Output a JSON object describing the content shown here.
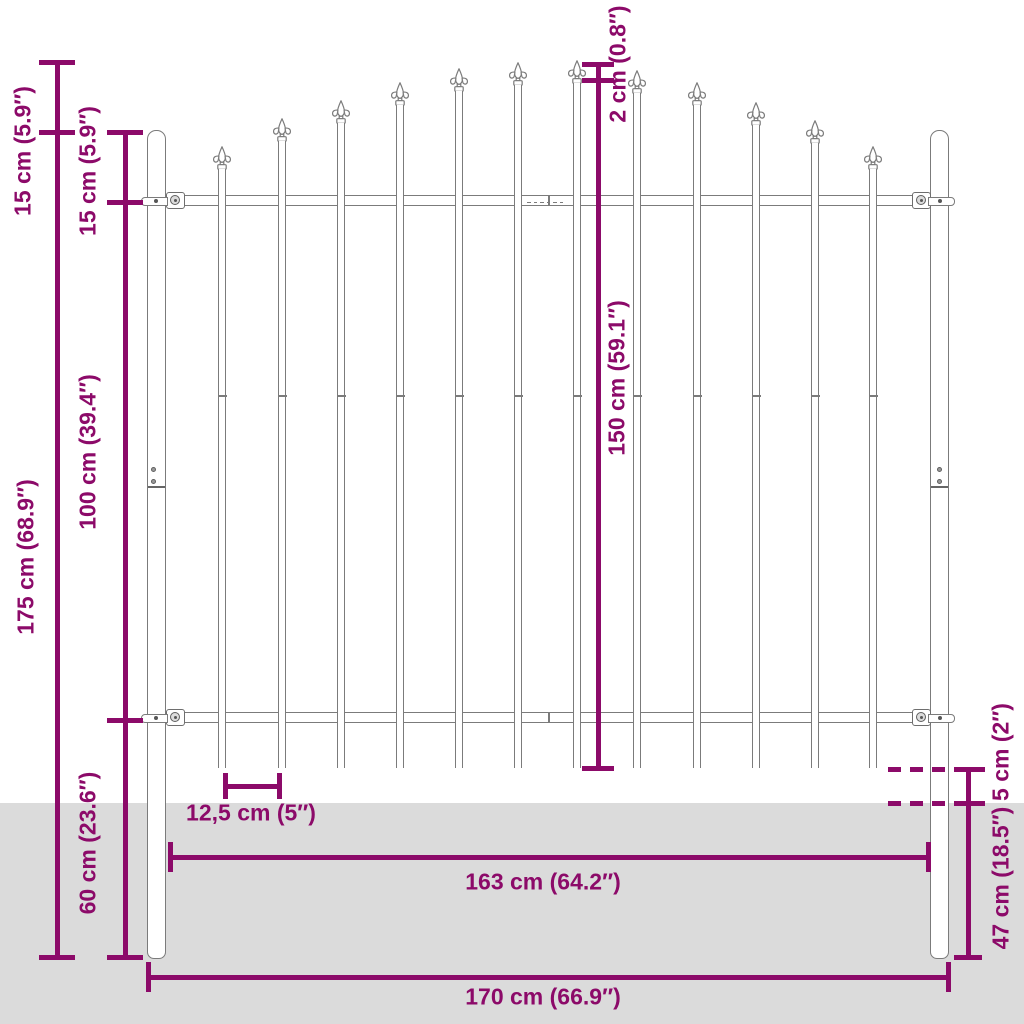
{
  "labels": {
    "spear_top_15": "15 cm (5.9″)",
    "total_175": "175 cm (68.9″)",
    "post_to_rail_15": "15 cm (5.9″)",
    "rail_span_100": "100 cm (39.4″)",
    "below_60": "60 cm (23.6″)",
    "step_2": "2 cm (0.8″)",
    "picket_150": "150 cm (59.1″)",
    "gap_125": "12,5 cm (5″)",
    "clearance_5": "5 cm (2″)",
    "depth_47": "47 cm (18.5″)",
    "inner_163": "163 cm (64.2″)",
    "total_170": "170 cm (66.9″)"
  },
  "colors": {
    "accent": "#8c0a69",
    "ground": "#dbdbdb",
    "stroke": "#7b7b7b"
  },
  "geometry": {
    "ground_y": 803,
    "posts": [
      {
        "x": 147,
        "y": 130,
        "w": 19,
        "h": 829
      },
      {
        "x": 930,
        "y": 130,
        "w": 19,
        "h": 829
      }
    ],
    "post_seam_y": 486,
    "screws": [
      [
        153,
        469
      ],
      [
        153,
        481
      ],
      [
        939,
        469
      ],
      [
        939,
        481
      ]
    ],
    "rails": [
      {
        "x": 166,
        "y": 195,
        "w": 764,
        "h": 10.5
      },
      {
        "x": 166,
        "y": 712,
        "w": 764,
        "h": 11
      }
    ],
    "rail_seam_x": 548,
    "weld_dashes": {
      "y": 201.5,
      "x0": 527,
      "count": 6,
      "step": 6.5,
      "len": 3.5
    },
    "pickets": {
      "width": 7.4,
      "bottom": 768,
      "joint_y": 395,
      "items": [
        [
          222,
          146
        ],
        [
          282,
          118
        ],
        [
          341,
          100
        ],
        [
          400,
          82
        ],
        [
          459,
          68
        ],
        [
          518,
          62
        ],
        [
          577,
          60
        ],
        [
          637,
          70
        ],
        [
          697,
          82
        ],
        [
          756,
          102
        ],
        [
          815,
          120
        ],
        [
          873,
          146
        ]
      ]
    },
    "brackets": [
      {
        "side": "L",
        "cx": 175,
        "cy": 200
      },
      {
        "side": "R",
        "cx": 921,
        "cy": 200
      },
      {
        "side": "L",
        "cx": 175,
        "cy": 717
      },
      {
        "side": "R",
        "cx": 921,
        "cy": 717
      }
    ],
    "dims": {
      "lw": 5,
      "vlines": [
        {
          "name": "total-height",
          "x": 57,
          "y1": 60,
          "y2": 959,
          "ticks": [
            62,
            132,
            957
          ],
          "tw": 36
        },
        {
          "name": "left-inner",
          "x": 125,
          "y1": 130,
          "y2": 959,
          "ticks": [
            132,
            202,
            720,
            957
          ],
          "tw": 36
        },
        {
          "name": "picket-height",
          "x": 598,
          "y1": 62,
          "y2": 770,
          "ticks": [
            64,
            80,
            768
          ],
          "tw": 32
        },
        {
          "name": "right-depth",
          "x": 968,
          "y1": 767,
          "y2": 959,
          "ticks": [
            769,
            803,
            957
          ],
          "tw": 28
        }
      ],
      "hlines": [
        {
          "name": "picket-gap",
          "y": 786,
          "x1": 225,
          "x2": 279,
          "ticks": [
            225,
            279
          ],
          "th": 26
        },
        {
          "name": "inner-width",
          "y": 857,
          "x1": 170,
          "x2": 928,
          "ticks": [
            170,
            928
          ],
          "th": 30
        },
        {
          "name": "total-width",
          "y": 977,
          "x1": 148,
          "x2": 948,
          "ticks": [
            148,
            948
          ],
          "th": 30
        }
      ],
      "dashlines": [
        {
          "name": "picket-bottom-level",
          "y": 769,
          "x1": 888,
          "x2": 985
        },
        {
          "name": "ground-level",
          "y": 803,
          "x1": 888,
          "x2": 985
        }
      ]
    }
  }
}
